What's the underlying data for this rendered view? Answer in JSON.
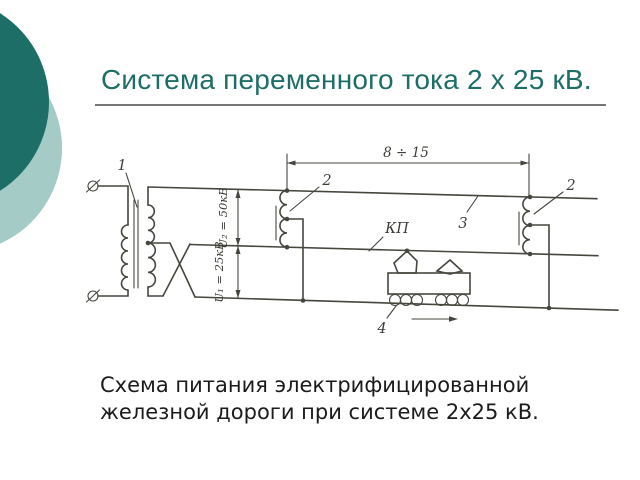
{
  "slide": {
    "title": "Система переменного тока 2 х 25 кВ.",
    "caption_line1": "Схема питания электрифицированной",
    "caption_line2": "железной дороги при системе 2х25 кВ.",
    "accent_color": "#1d6e66",
    "accent_color_light": "#a5cbc6"
  },
  "diagram": {
    "labels": {
      "transformer": "1",
      "autotransformer_left": "2",
      "autotransformer_right": "2",
      "feeder_wire": "3",
      "locomotive": "4",
      "contact_wire": "КП",
      "span_length": "8 ÷ 15",
      "voltage_upper": "U₂ = 50кВ",
      "voltage_lower": "U₁ = 25кВ"
    }
  }
}
